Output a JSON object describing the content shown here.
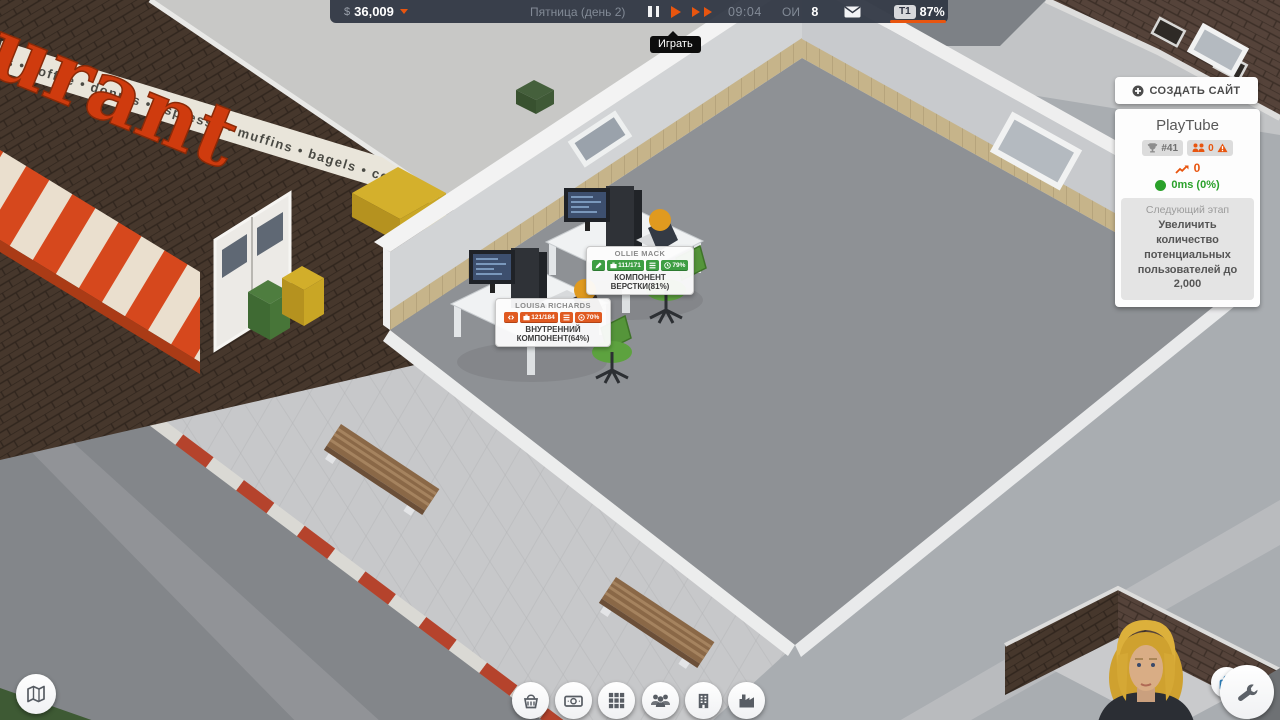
{
  "top_bar": {
    "currency": "$",
    "money": "36,009",
    "date": "Пятница (день 2)",
    "time": "09:04",
    "oi_label": "ОИ",
    "oi_value": "8",
    "team_tab": "T1",
    "team_pct": "87%"
  },
  "play_tooltip": "Играть",
  "site_panel": {
    "create_button": "СОЗДАТЬ САЙТ",
    "site_name": "PlayTube",
    "rank": "#41",
    "users": "0",
    "growth": "0",
    "latency": "0ms (0%)",
    "next_stage_label": "Следующий этап",
    "next_stage_text": "Увеличить количество потенциальных пользователей до 2,000"
  },
  "workers": {
    "ollie": {
      "name": "OLLIE MACK",
      "inventory": "111/171",
      "timer_pct": "79%",
      "task": "КОМПОНЕНТ ВЕРСТКИ(81%)"
    },
    "louisa": {
      "name": "LOUISA RICHARDS",
      "inventory": "121/184",
      "salary_pct": "70%",
      "task": "ВНУТРЕННИЙ КОМПОНЕНТ(64%)"
    }
  },
  "scene": {
    "restaurant_sign": "urant",
    "restaurant_band": "s • coffee • donuts • espresso • muffins • bagels • coffee • donuts • e",
    "fps": "60"
  },
  "colors": {
    "accent": "#e8550f",
    "green_badge": "#3d9e43",
    "orange_badge": "#e05a21",
    "latency_green": "#2aa12a"
  }
}
